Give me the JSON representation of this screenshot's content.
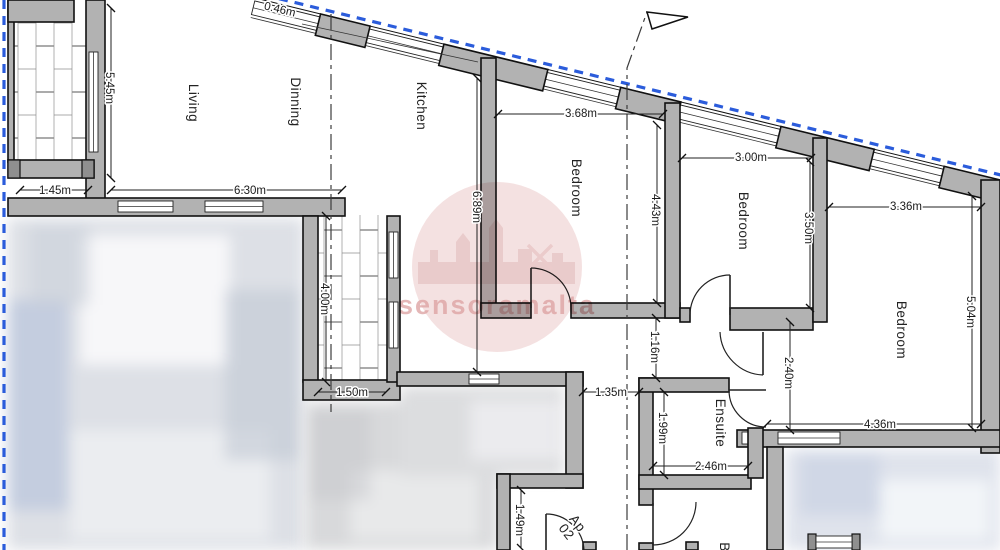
{
  "watermark": {
    "text": "sensoramalta"
  },
  "apartment": {
    "line1": "Ap",
    "line2": "02"
  },
  "rooms": {
    "living": "Living",
    "dinning": "Dinning",
    "kitchen": "Kitchen",
    "bedroom1": "Bedroom",
    "bedroom2": "Bedroom",
    "bedroom3": "Bedroom",
    "ensuite": "Ensuite",
    "bathroom_partial": "B"
  },
  "dims": {
    "boundary_segment": "0.46m",
    "balcony1_height": "5.45m",
    "balcony1_width": "1.45m",
    "living_dining_width": "6.30m",
    "kitchen_depth": "6.89m",
    "bedroom1_width": "3.68m",
    "bedroom1_depth": "4.43m",
    "bedroom2_width": "3.00m",
    "bedroom2_depth": "3.50m",
    "bedroom3_width": "3.36m",
    "bedroom3_depth": "5.04m",
    "bedroom3_south_width": "4.36m",
    "balcony2_depth": "4.00m",
    "balcony2_width": "1.50m",
    "hall_passage": "1.35m",
    "corridor_width": "1.16m",
    "hall_depth": "2.40m",
    "ensuite_depth": "1.99m",
    "ensuite_width": "2.46m",
    "entrance_recess": "1.49m"
  },
  "colors": {
    "wall_fill": "#b2b2b2",
    "outline": "#111111",
    "boundary_blue": "#2b5cdb",
    "watermark_pink": "#d89494",
    "centerline": "#3c3c3c"
  }
}
